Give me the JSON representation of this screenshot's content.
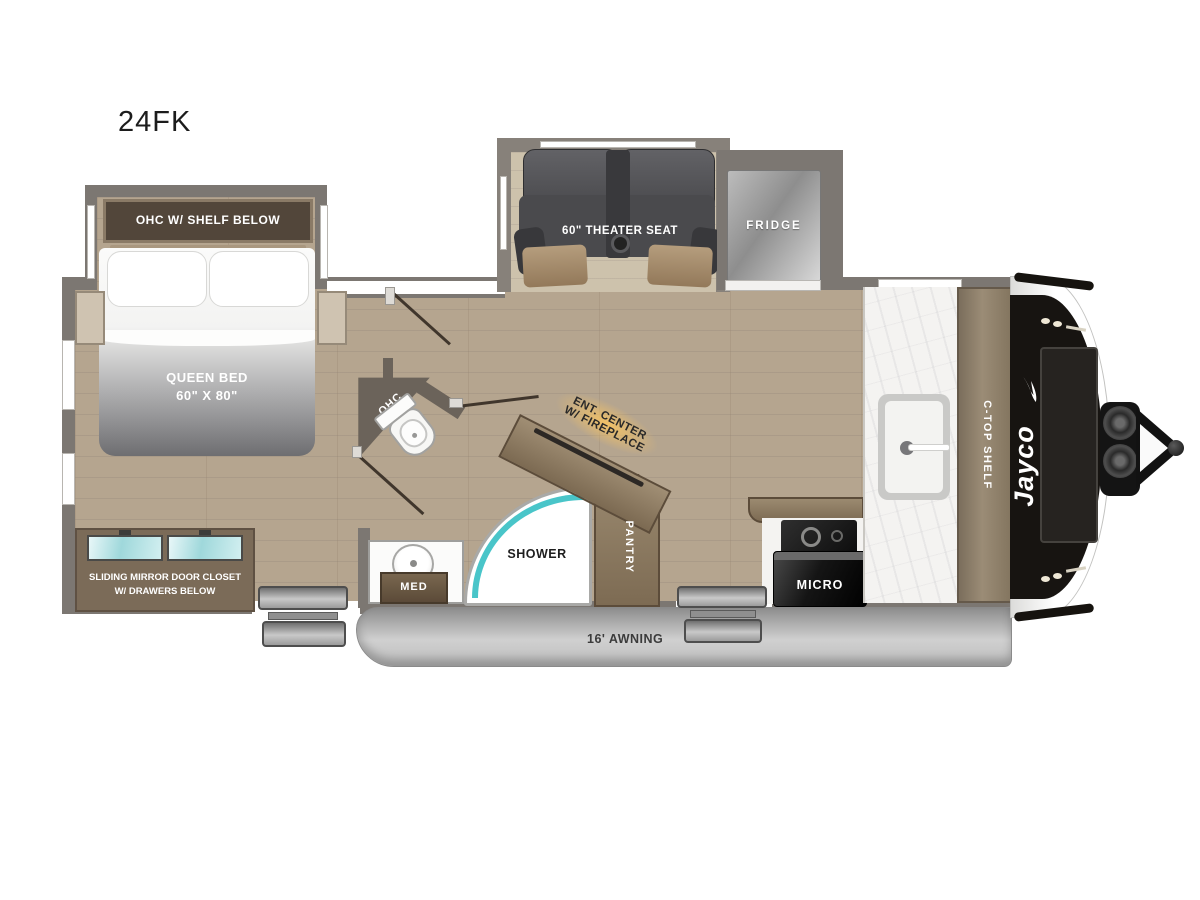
{
  "title": "24FK",
  "colors": {
    "wall": "#7c7772",
    "floor_wood": "#b5a58f",
    "cabinet_wood": "#8d7a63",
    "accent_teal": "#49c5c9",
    "fireplace_glow": "#f2c370",
    "seat_gray": "#4a4a4d"
  },
  "bedroom": {
    "ohc_label": "OHC W/ SHELF BELOW",
    "bed_label_line1": "QUEEN BED",
    "bed_label_line2": "60\" X 80\"",
    "closet_label_line1": "SLIDING MIRROR DOOR CLOSET",
    "closet_label_line2": "W/ DRAWERS BELOW"
  },
  "bath": {
    "ohc_label": "OHC",
    "med_label": "MED",
    "shower_label": "SHOWER"
  },
  "living": {
    "theater_label": "60\" THEATER SEAT",
    "fridge_label": "FRIDGE",
    "ent_label_line1": "ENT. CENTER",
    "ent_label_line2": "W/ FIREPLACE",
    "pantry_label": "PANTRY"
  },
  "kitchen": {
    "micro_label": "MICRO",
    "ctop_label": "C-TOP SHELF"
  },
  "exterior": {
    "awning_label": "16' AWNING",
    "brand_label": "Jayco"
  }
}
